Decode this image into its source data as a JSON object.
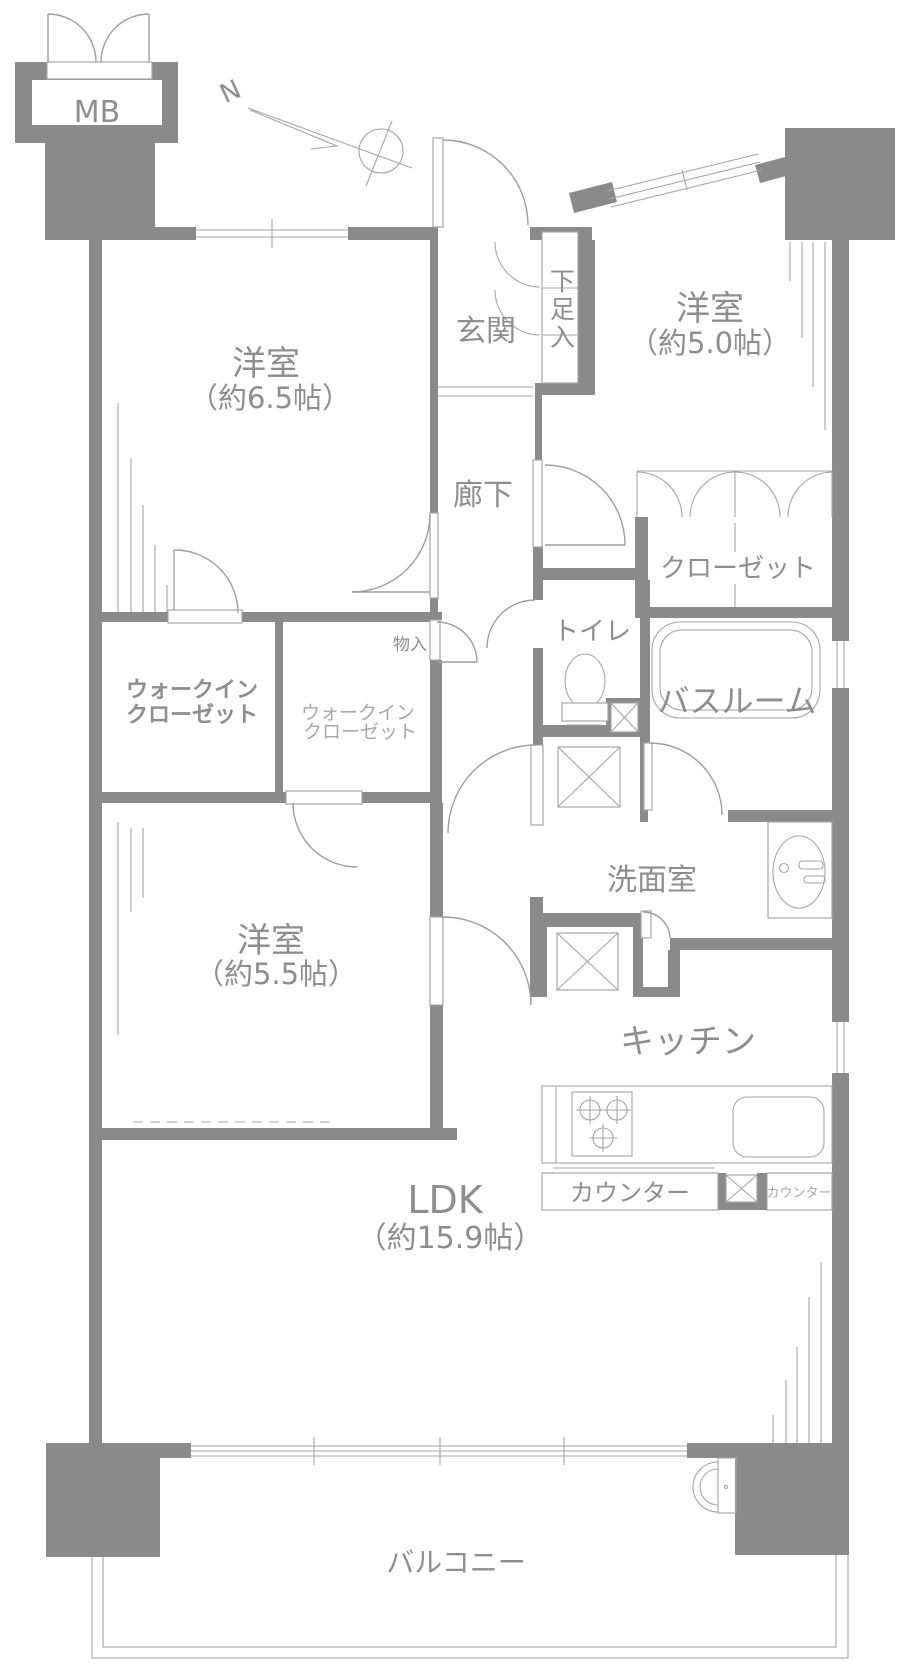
{
  "title": "マンション間取り図",
  "colors": {
    "wall": "#8a8a8a",
    "line": "#9e9e9e",
    "text": "#8e8e8e",
    "text_light": "#a8a8a8",
    "background": "#ffffff"
  },
  "compass": {
    "north_label": "N"
  },
  "meter_box": {
    "label": "MB"
  },
  "rooms": {
    "bedroom1": {
      "name": "洋室",
      "area": "（約6.5帖）"
    },
    "bedroom2": {
      "name": "洋室",
      "area": "（約5.0帖）"
    },
    "bedroom3": {
      "name": "洋室",
      "area": "（約5.5帖）"
    },
    "ldk": {
      "name": "LDK",
      "area": "（約15.9帖）"
    },
    "entrance": {
      "name": "玄関"
    },
    "shoe_cabinet": {
      "name": "下足入"
    },
    "hallway": {
      "name": "廊下"
    },
    "closet": {
      "name": "クローゼット"
    },
    "toilet": {
      "name": "トイレ"
    },
    "bathroom": {
      "name": "バスルーム"
    },
    "walk_in_closet_1": {
      "line1": "ウォークイン",
      "line2": "クローゼット"
    },
    "walk_in_closet_2": {
      "line1": "ウォークイン",
      "line2": "クローゼット"
    },
    "storage": {
      "name": "物入"
    },
    "washroom": {
      "name": "洗面室"
    },
    "kitchen": {
      "name": "キッチン"
    },
    "counter_main": {
      "name": "カウンター"
    },
    "counter_sub": {
      "name": "カウンター"
    },
    "balcony": {
      "name": "バルコニー"
    }
  }
}
